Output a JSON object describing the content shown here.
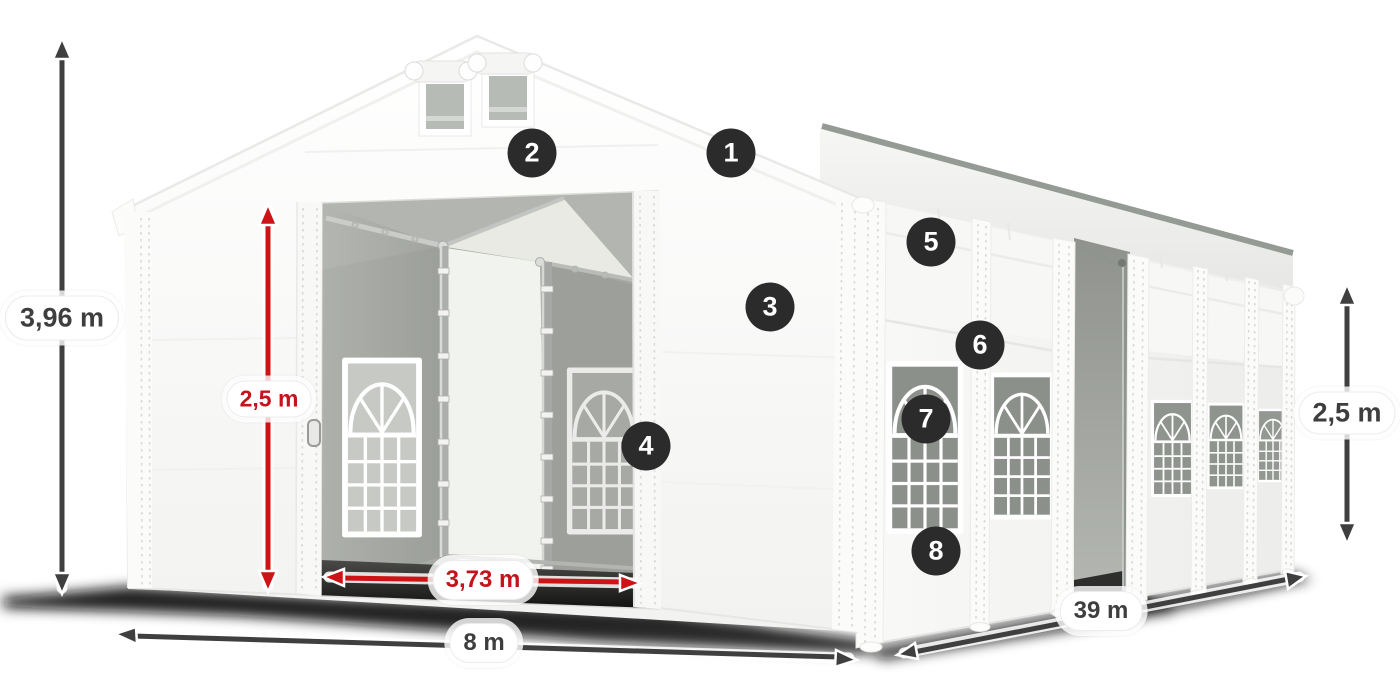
{
  "diagram": {
    "title": "White marquee tent with dimension annotations and numbered feature callouts",
    "dimensions": {
      "total_height": "3,96 m",
      "entrance_height": "2,5 m",
      "entrance_width": "3,73 m",
      "gable_width": "8 m",
      "length": "39 m",
      "side_height": "2,5 m"
    },
    "callouts": [
      {
        "number": "1"
      },
      {
        "number": "2"
      },
      {
        "number": "3"
      },
      {
        "number": "4"
      },
      {
        "number": "5"
      },
      {
        "number": "6"
      },
      {
        "number": "7"
      },
      {
        "number": "8"
      }
    ],
    "colors": {
      "dimension_arrow_dark": "#3f3f3f",
      "dimension_arrow_red": "#ce1317",
      "dimension_text_dark": "#3e3e3e",
      "dimension_text_red": "#c5121b",
      "badge_background": "#2b2b2b",
      "badge_text": "#ffffff",
      "tent_fabric": "#ffffff",
      "window_glass": "#8b908b",
      "interior_wall": "#a7aaa5"
    }
  }
}
